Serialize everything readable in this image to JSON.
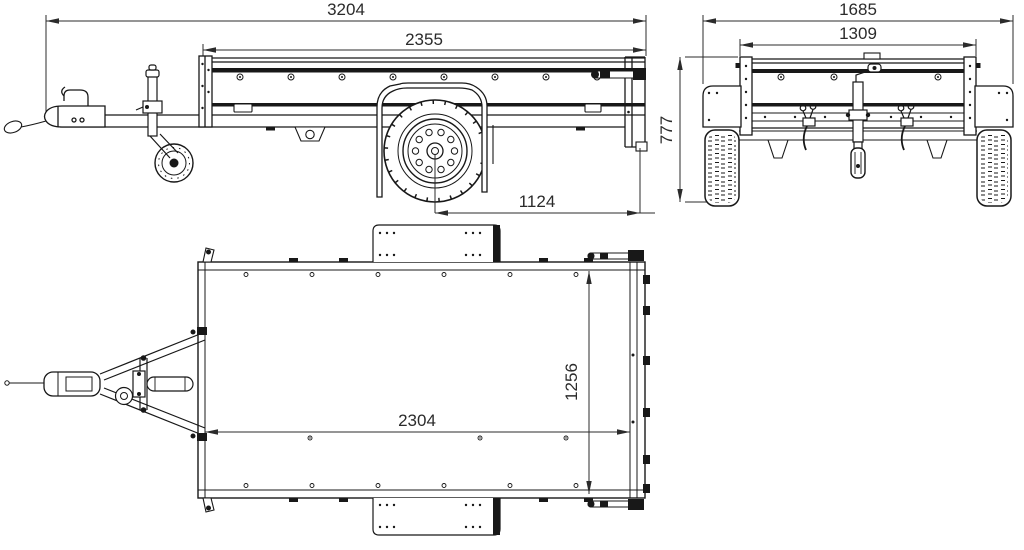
{
  "colors": {
    "background": "#ffffff",
    "drawing_line": "#181818",
    "dimension_line": "#2b2b2b"
  },
  "views": {
    "side": {
      "dimensions": {
        "overall_length": "3204",
        "box_length": "2355",
        "axle_to_rear": "1124"
      }
    },
    "front": {
      "dimensions": {
        "overall_width": "1685",
        "box_width": "1309",
        "overall_height": "777"
      }
    },
    "top": {
      "dimensions": {
        "inner_length": "2304",
        "inner_width": "1256"
      }
    }
  }
}
